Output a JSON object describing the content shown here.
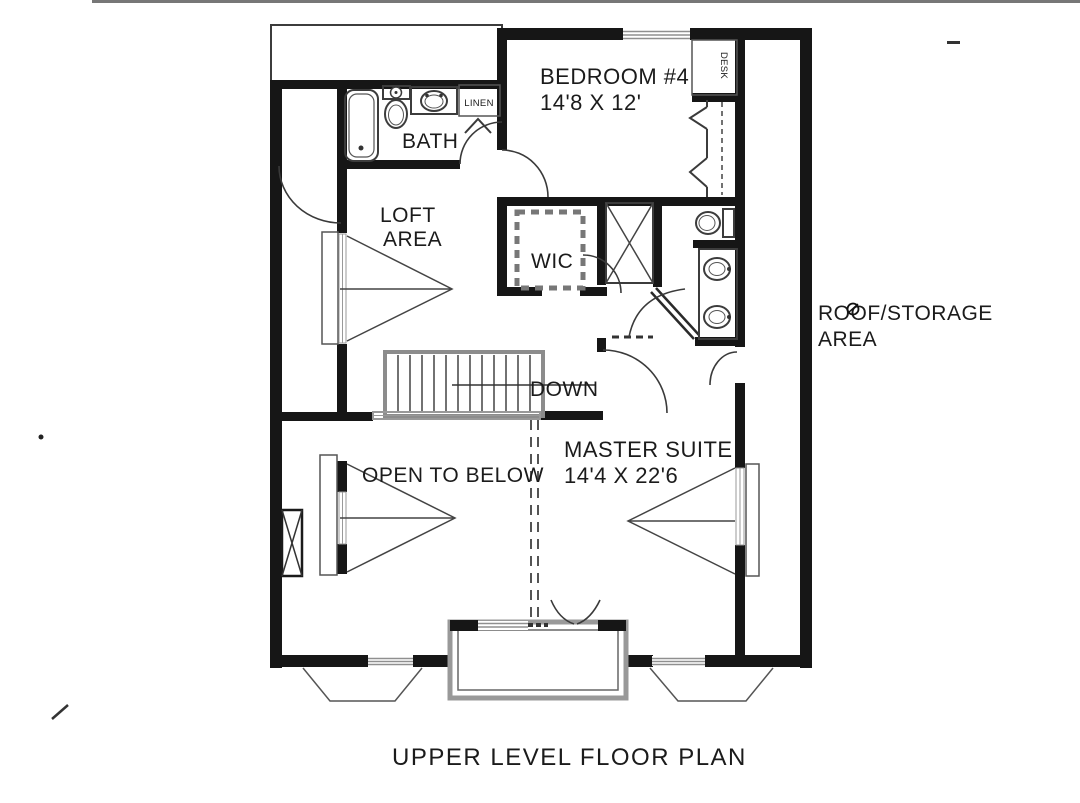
{
  "title": "UPPER LEVEL FLOOR PLAN",
  "rooms": {
    "bedroom4": {
      "name": "BEDROOM #4",
      "dims": "14'8 X 12'"
    },
    "bath": {
      "name": "BATH"
    },
    "linen": {
      "name": "LINEN"
    },
    "desk": {
      "name": "DESK"
    },
    "loft": {
      "line1": "LOFT",
      "line2": "AREA"
    },
    "wic": {
      "name": "WIC"
    },
    "stairs": {
      "direction": "DOWN"
    },
    "master_suite": {
      "name": "MASTER SUITE",
      "dims": "14'4 X 22'6"
    },
    "open_to_below": {
      "name": "OPEN TO BELOW"
    },
    "roof_storage": {
      "line1": "ROOF/STORAGE",
      "line2": "AREA"
    }
  },
  "fixtures": [
    "bathtub",
    "toilet",
    "vanity-sink",
    "linen-closet-door",
    "bifold-closet-doors",
    "desk-nook",
    "shower-stall",
    "water-closet-toilet",
    "double-vanity-sinks",
    "staircase-down",
    "fireplace-chimney",
    "bay-window-left",
    "box-bay-french-doors",
    "bay-window-right",
    "window-triangle-loft",
    "window-triangle-open-below",
    "window-triangle-master"
  ],
  "colors": {
    "paper": "#ffffff",
    "wall": "#161616",
    "thin_line": "#3c3c3c",
    "glazing": "#8f8f8f",
    "stair_rail": "#8c8c8c",
    "text": "#1b1b1b"
  }
}
